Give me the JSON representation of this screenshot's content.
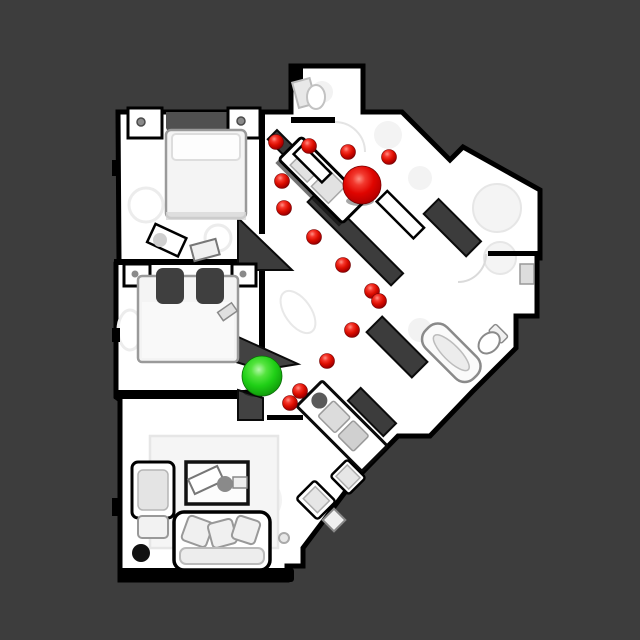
{
  "scene": {
    "description": "top-down textured 3D scan of an apartment floor plan with navigation episode markers",
    "background_color": "#3d3d3d",
    "floor_color": "#ffffff",
    "wall_color": "#000000",
    "cut_wall_color": "#3c3c3c",
    "canvas": {
      "width": 640,
      "height": 640
    }
  },
  "markers": {
    "start": {
      "label": "start-sphere",
      "color": "#1fcf16",
      "x": 262,
      "y": 376,
      "r": 20
    },
    "goal": {
      "label": "goal-sphere",
      "color": "#e00500",
      "x": 362,
      "y": 185,
      "r": 19
    },
    "waypoint_color": "#dc0e00",
    "waypoint_radius": 7.5,
    "waypoint_count": 14,
    "waypoints": [
      {
        "x": 276,
        "y": 142
      },
      {
        "x": 309,
        "y": 146
      },
      {
        "x": 348,
        "y": 152
      },
      {
        "x": 389,
        "y": 157
      },
      {
        "x": 282,
        "y": 181
      },
      {
        "x": 284,
        "y": 208
      },
      {
        "x": 314,
        "y": 237
      },
      {
        "x": 343,
        "y": 265
      },
      {
        "x": 372,
        "y": 291
      },
      {
        "x": 379,
        "y": 301
      },
      {
        "x": 352,
        "y": 330
      },
      {
        "x": 327,
        "y": 361
      },
      {
        "x": 300,
        "y": 391
      },
      {
        "x": 290,
        "y": 403
      }
    ]
  }
}
